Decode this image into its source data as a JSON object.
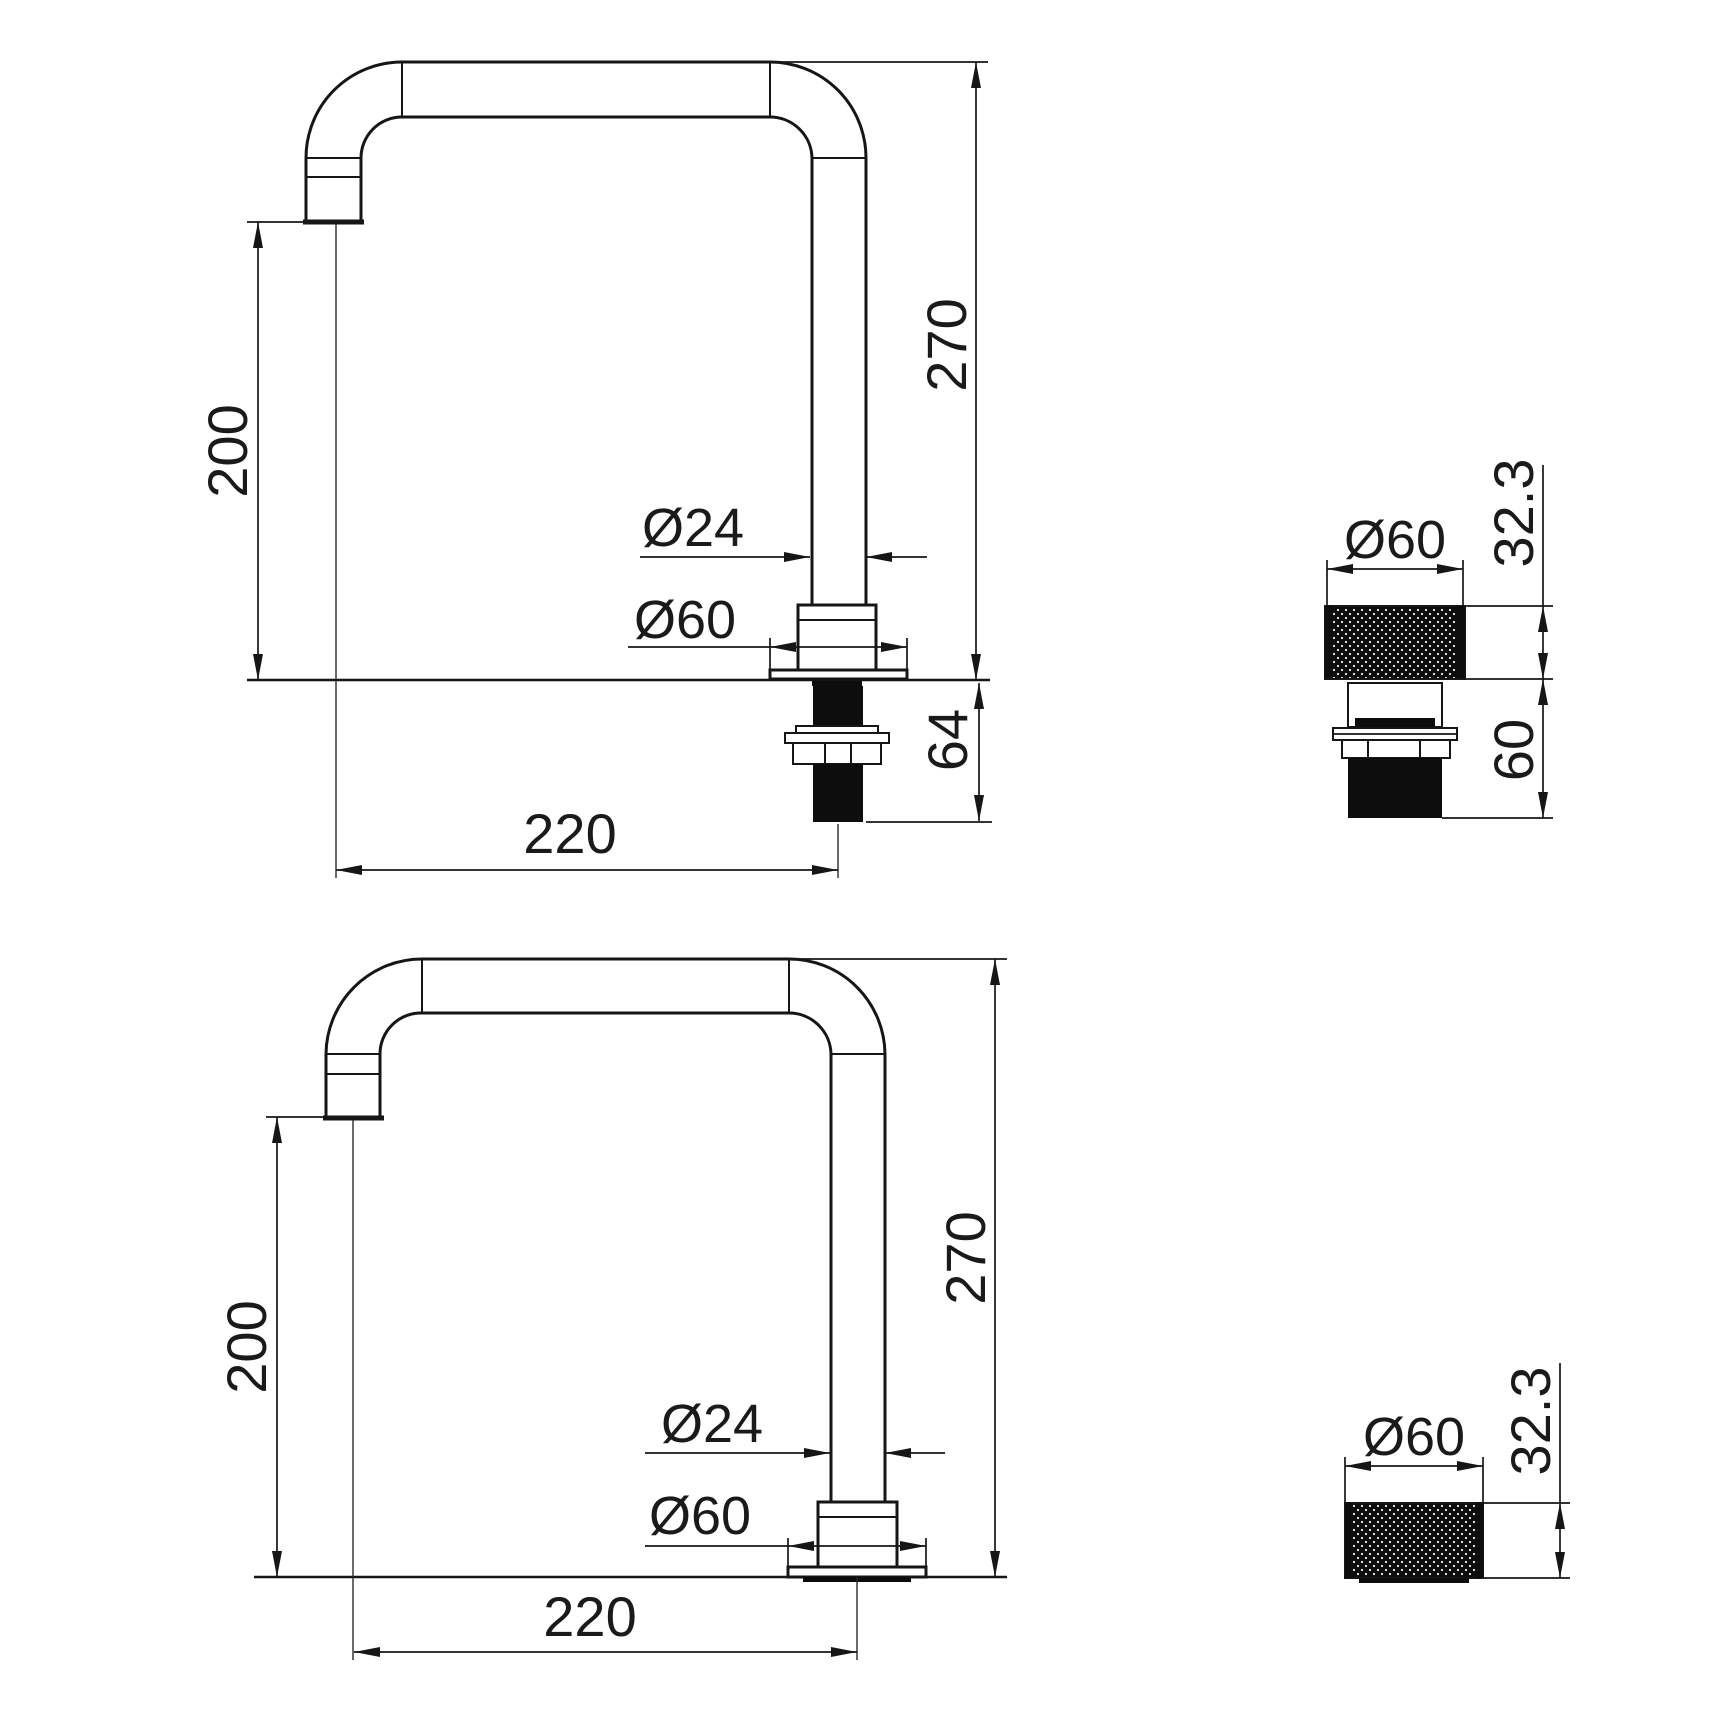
{
  "document": {
    "type": "technical dimension drawing",
    "subject": "kitchen faucet swivel spout and knurled control handle",
    "unit": "mm"
  },
  "colors": {
    "background": "#ffffff",
    "line": "#161616",
    "text": "#1a1a1a",
    "solid_fill": "#0d0d0d"
  },
  "views": {
    "spout_with_shank": {
      "dims": {
        "height": "270",
        "clearance": "200",
        "reach": "220",
        "tube_dia": "Ø24",
        "flange_dia": "Ø60",
        "shank_length": "64"
      }
    },
    "spout_plain": {
      "dims": {
        "height": "270",
        "clearance": "200",
        "reach": "220",
        "tube_dia": "Ø24",
        "flange_dia": "Ø60"
      }
    },
    "handle_full": {
      "dims": {
        "dia": "Ø60",
        "cap_height": "32.3",
        "lower_length": "60"
      }
    },
    "handle_cap": {
      "dims": {
        "dia": "Ø60",
        "cap_height": "32.3"
      }
    }
  }
}
